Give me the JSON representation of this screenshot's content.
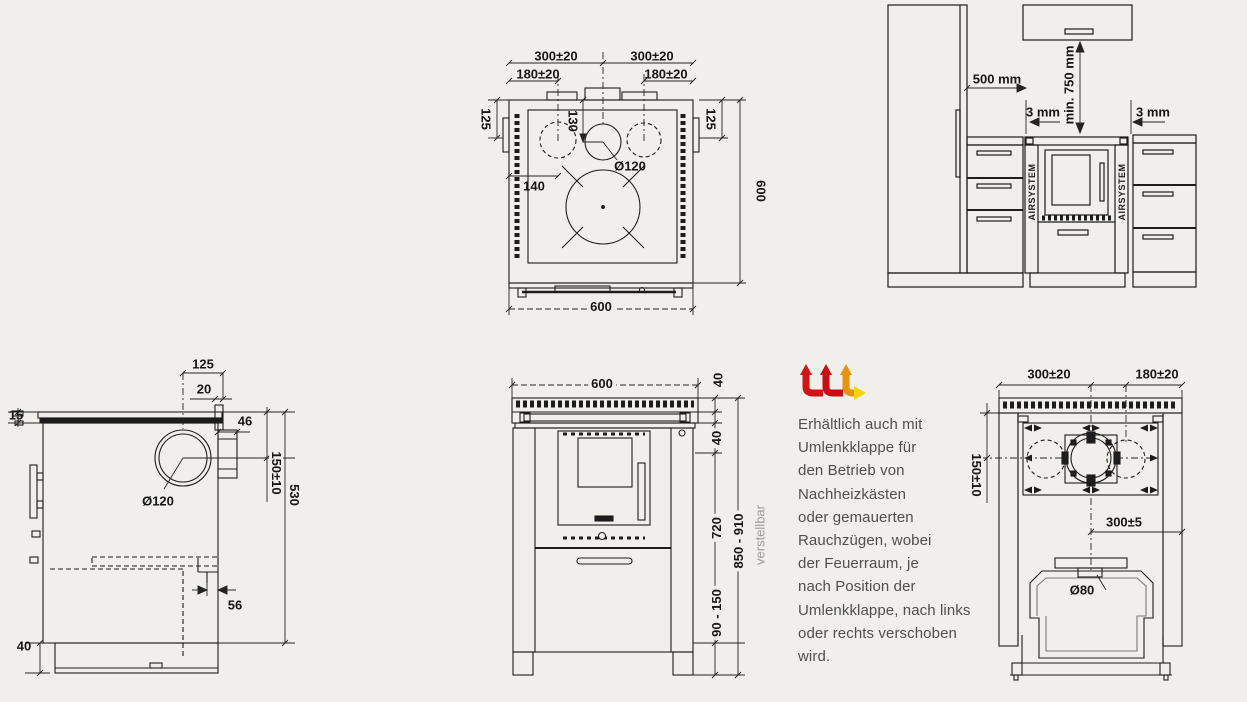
{
  "canvas": {
    "bg": "#f0efec",
    "line_color": "#1d1d1d"
  },
  "logo": {
    "name": "airsystem-flow-logo",
    "red": "#d11517",
    "orange": "#e79310",
    "yellow": "#f4d40a"
  },
  "info_text": {
    "lines": [
      "Erhältlich auch mit",
      "Umlenkklappe für",
      "den Betrieb von",
      "Nachheizkästen",
      "oder gemauerten",
      "Rauchzügen, wobei",
      "der Feuerraum, je",
      "nach Position der",
      "Umlenkklappe, nach links",
      "oder rechts verschoben",
      "wird."
    ]
  },
  "top_view": {
    "dims": {
      "w300_left": "300±20",
      "w300_right": "300±20",
      "w180_left": "180±20",
      "w180_right": "180±20",
      "d125_left": "125",
      "d125_right": "125",
      "d130": "130",
      "dia120": "Ø120",
      "d140": "140",
      "h600": "600",
      "w600": "600"
    }
  },
  "installation_view": {
    "dims": {
      "d500": "500 mm",
      "gap_left": "3 mm",
      "min750": "min. 750 mm",
      "gap_right": "3 mm"
    },
    "airsystem": "AIRSYSTEM"
  },
  "side_view": {
    "dims": {
      "d125": "125",
      "d20": "20",
      "d15": "15",
      "d46": "46",
      "d150": "150±10",
      "d530": "530",
      "dia120": "Ø120",
      "d56": "56",
      "d40": "40"
    }
  },
  "front_view": {
    "dims": {
      "w600": "600",
      "d40_top": "40",
      "d40_mid": "40",
      "d720": "720",
      "h850": "850 - 910",
      "d90": "90 - 150",
      "verstellbar": "verstellbar"
    }
  },
  "rear_view": {
    "dims": {
      "w300": "300±20",
      "w180": "180±20",
      "d150": "150±10",
      "d300": "300±5",
      "dia80": "Ø80"
    }
  }
}
